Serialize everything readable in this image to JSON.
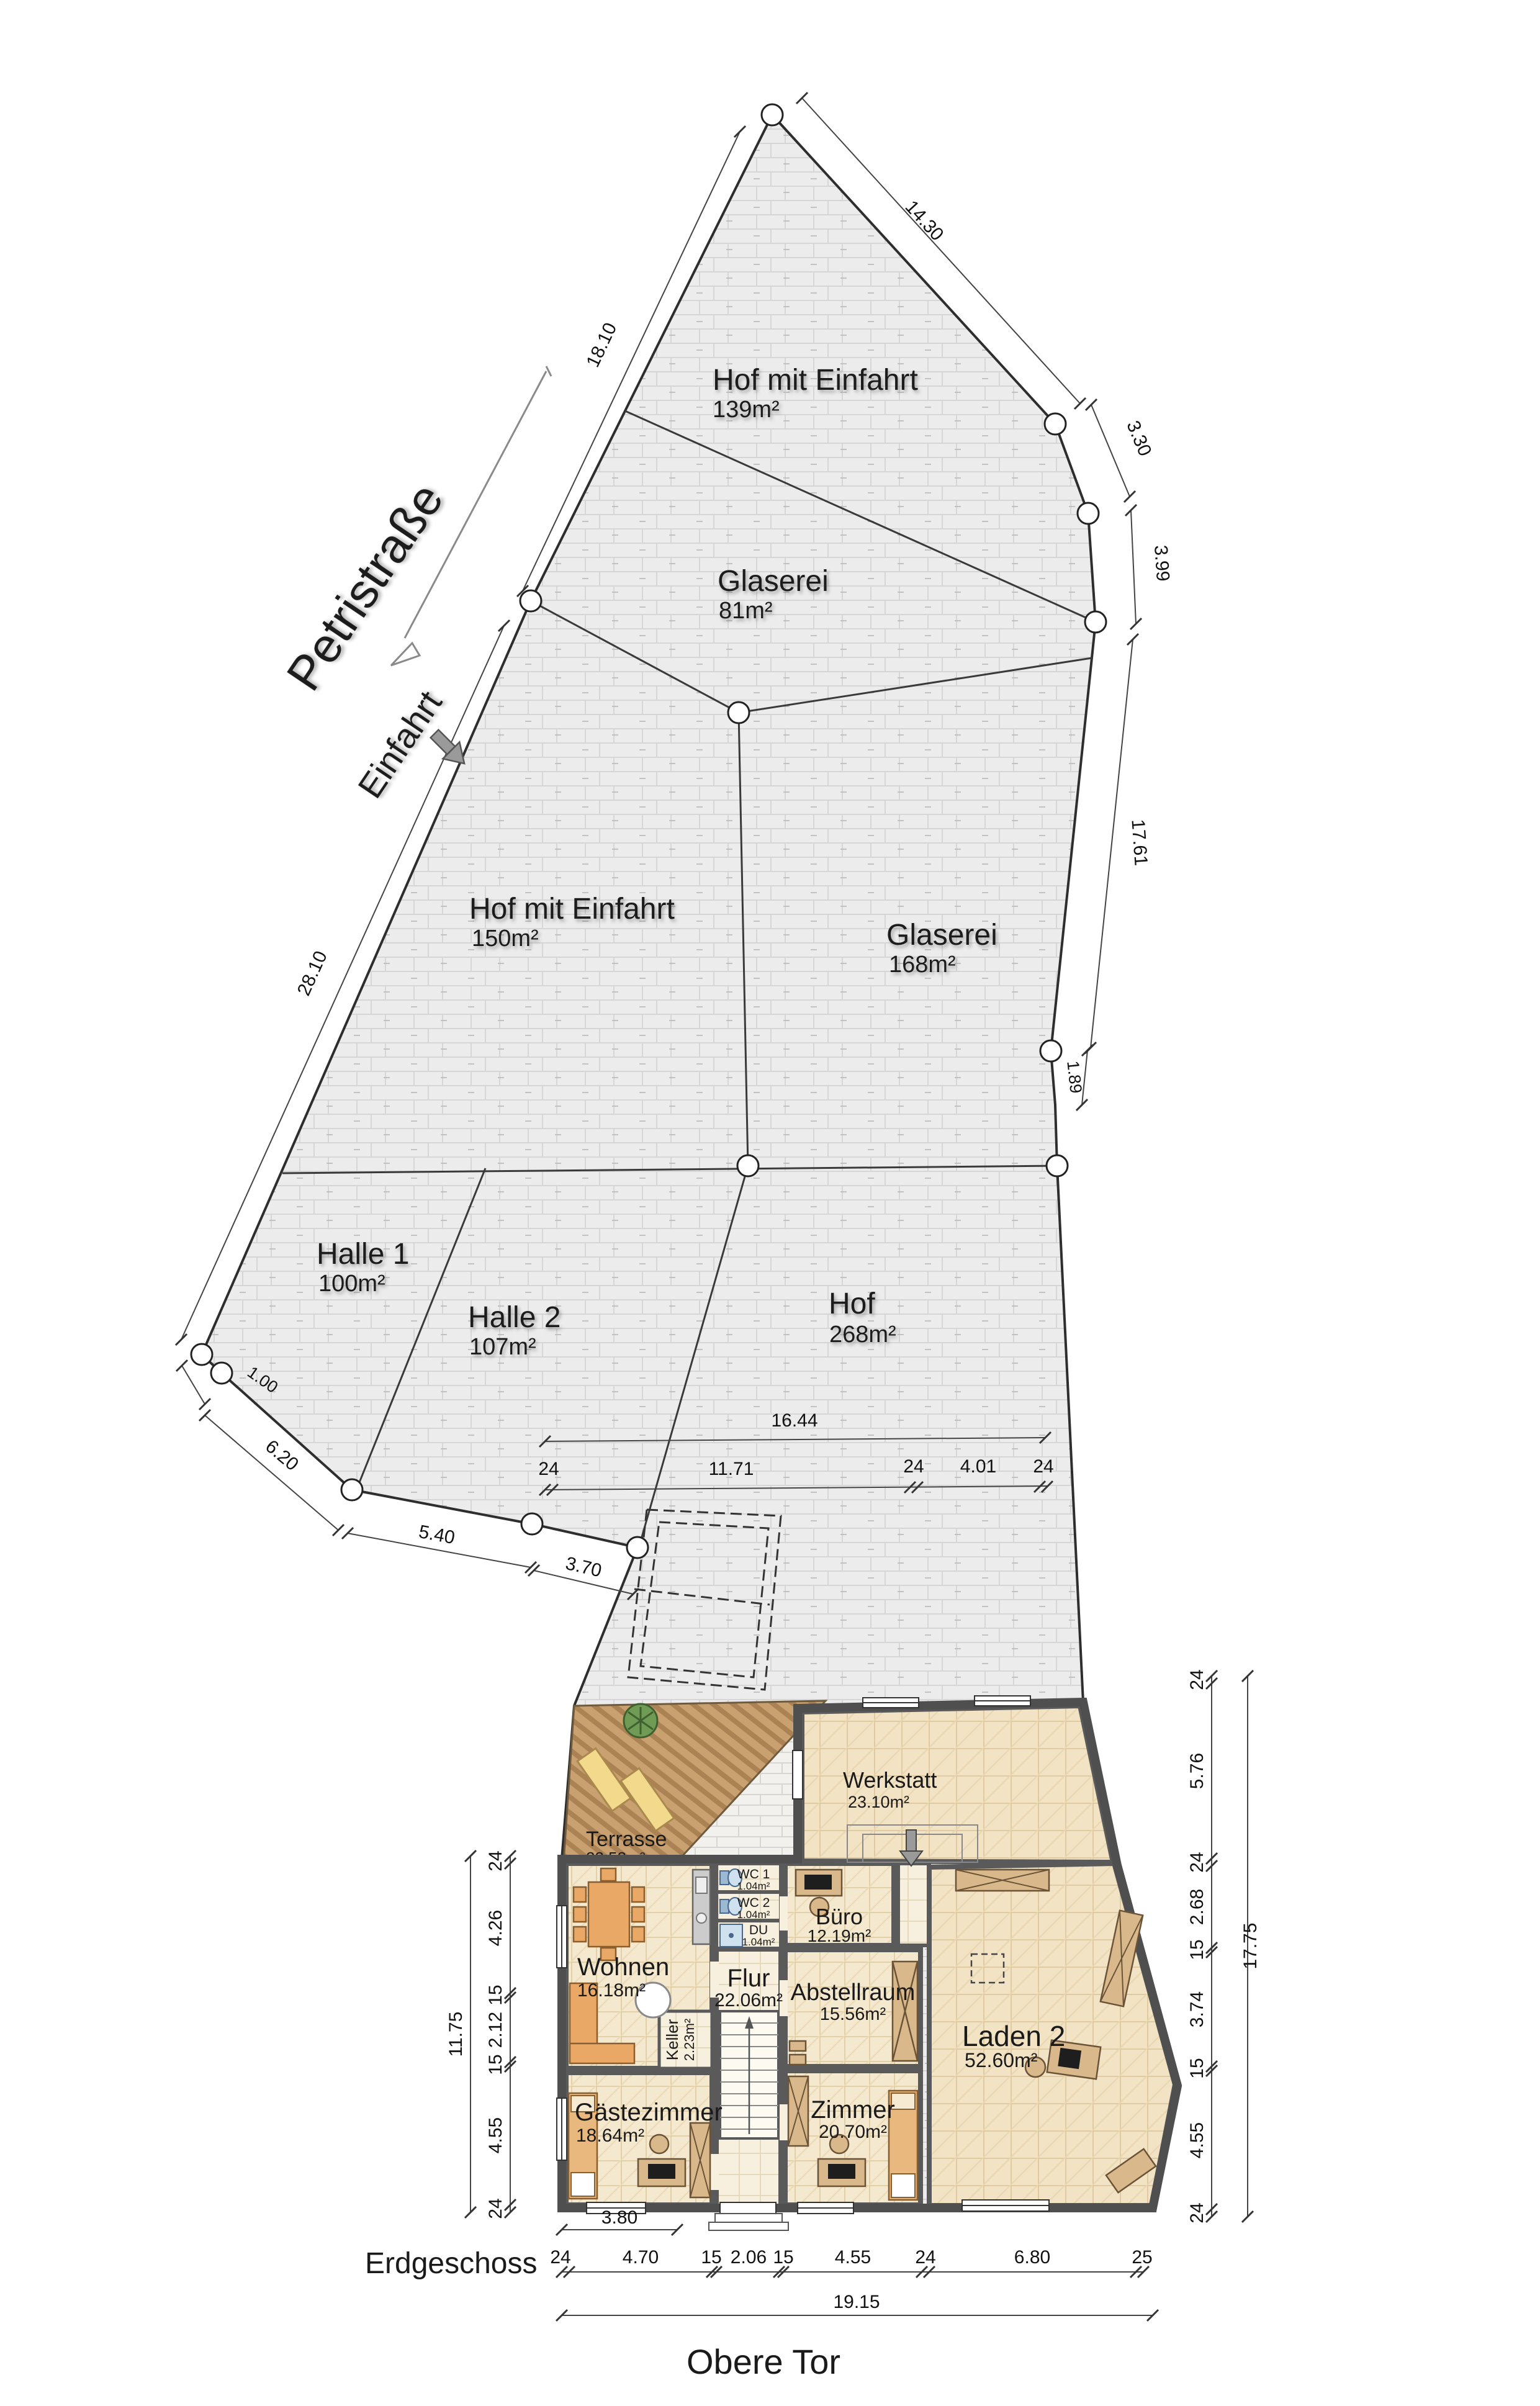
{
  "titles": {
    "floor": "Erdgeschoss",
    "street_bottom": "Obere Tor"
  },
  "streets": {
    "main": "Petristraße",
    "entrance": "Einfahrt"
  },
  "areas": {
    "hof139": {
      "name": "Hof mit Einfahrt",
      "area": "139m²"
    },
    "glaserei81": {
      "name": "Glaserei",
      "area": "81m²"
    },
    "hof150": {
      "name": "Hof mit Einfahrt",
      "area": "150m²"
    },
    "glaserei168": {
      "name": "Glaserei",
      "area": "168m²"
    },
    "halle1": {
      "name": "Halle 1",
      "area": "100m²"
    },
    "halle2": {
      "name": "Halle 2",
      "area": "107m²"
    },
    "hof268": {
      "name": "Hof",
      "area": "268m²"
    }
  },
  "rooms": {
    "terrasse": {
      "name": "Terrasse",
      "area": "22.53m²"
    },
    "werkstatt": {
      "name": "Werkstatt",
      "area": "23.10m²"
    },
    "wohnen": {
      "name": "Wohnen",
      "area": "16.18m²"
    },
    "wc1": {
      "name": "WC 1",
      "area": "1.04m²"
    },
    "wc2": {
      "name": "WC 2",
      "area": "1.04m²"
    },
    "du": {
      "name": "DU",
      "area": "1.04m²"
    },
    "flur": {
      "name": "Flur",
      "area": "22.06m²"
    },
    "keller": {
      "name": "Keller",
      "area": "2.23m²"
    },
    "buero": {
      "name": "Büro",
      "area": "12.19m²"
    },
    "abstellraum": {
      "name": "Abstellraum",
      "area": "15.56m²"
    },
    "laden2": {
      "name": "Laden 2",
      "area": "52.60m²"
    },
    "gaestezimmer": {
      "name": "Gästezimmer",
      "area": "18.64m²"
    },
    "zimmer": {
      "name": "Zimmer",
      "area": "20.70m²"
    }
  },
  "dims": {
    "street_upper": "18.10",
    "street_lower": "28.10",
    "ne_edge": "14.30",
    "e1": "3.30",
    "e2": "3.99",
    "e3": "17.61",
    "e4": "1.89",
    "sw1": "1.00",
    "sw2": "6.20",
    "sw3": "5.40",
    "sw4": "3.70",
    "hof_width": "16.44",
    "mid_chain": [
      "24",
      "11.71",
      "24",
      "4.01",
      "24"
    ],
    "bottom_sub": "3.80",
    "bottom_chain": [
      "24",
      "4.70",
      "15",
      "2.06",
      "15",
      "4.55",
      "24",
      "6.80",
      "25"
    ],
    "bottom_total": "19.15",
    "left_chain": [
      "24",
      "4.26",
      "15",
      "2.12",
      "15",
      "4.55",
      "24"
    ],
    "left_total": "11.75",
    "right_chain": [
      "24",
      "5.76",
      "24",
      "2.68",
      "15",
      "3.74",
      "15",
      "4.55",
      "24"
    ],
    "right_total": "17.75"
  },
  "colors": {
    "paving": "#ececec",
    "deck": "#c9a06f",
    "room_floor": "#f4e8cf",
    "wall": "#5a5a5a",
    "furniture": "#e9a866",
    "sanitary": "#9db8d2"
  }
}
